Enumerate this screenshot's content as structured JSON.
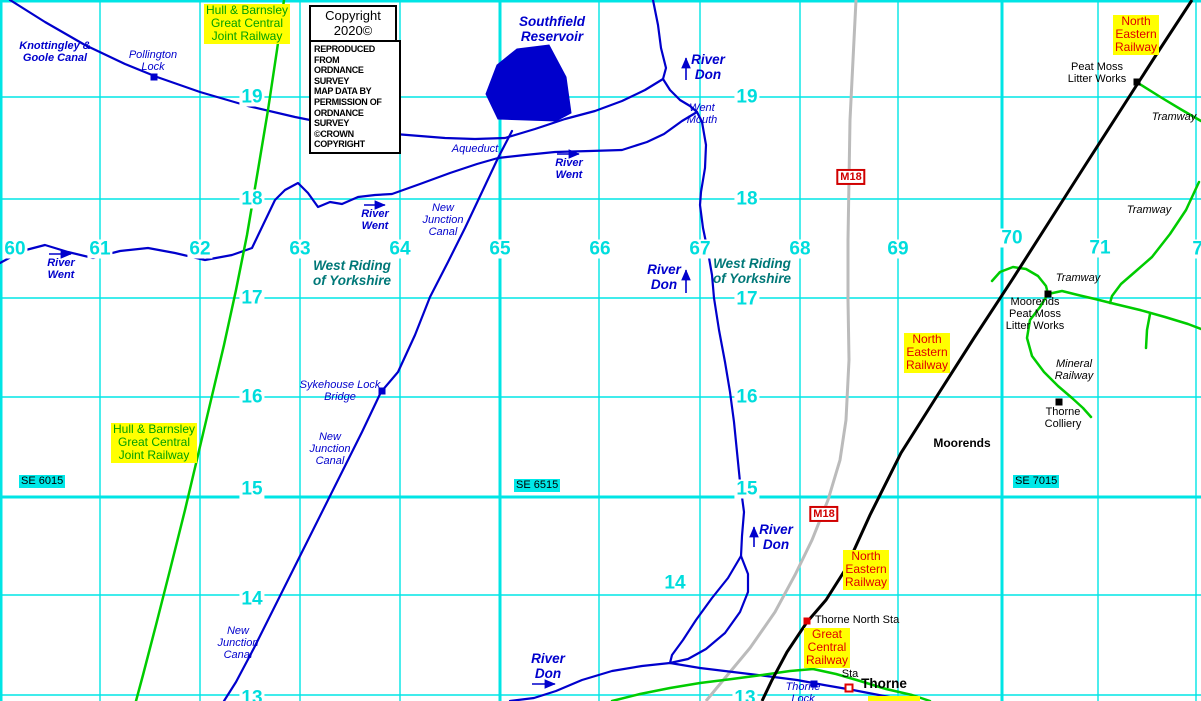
{
  "map": {
    "title": "Keymaps GB railway map — Thorne / Moorends area",
    "colors": {
      "grid_cyan": "#00E5E5",
      "waterway_blue": "#0000CC",
      "railway_green": "#00CC00",
      "railway_black": "#000000",
      "road_grey": "#BBBBBB",
      "highlight_yellow": "#FFFF00",
      "label_red": "#E00000",
      "label_teal": "#007878"
    },
    "attribution": {
      "line1": "Copyright 2020©",
      "line2": "KeymapsGB"
    },
    "os_notice": [
      "REPRODUCED FROM",
      "ORDNANCE SURVEY",
      "MAP DATA BY",
      "PERMISSION OF",
      "ORDNANCE SURVEY",
      "©CROWN COPYRIGHT"
    ],
    "labels": [
      {
        "id": "knottingley-goole-canal",
        "style": "wib",
        "x": 55,
        "y": 41,
        "lines": [
          "Knottingley &",
          "Goole Canal"
        ]
      },
      {
        "id": "pollington-lock",
        "style": "wi",
        "x": 153,
        "y": 50,
        "lines": [
          "Pollington",
          "Lock"
        ]
      },
      {
        "id": "hull-barnsley-railway-1",
        "style": "yg",
        "x": 247,
        "y": 4,
        "lines": [
          "Hull & Barnsley",
          "Great Central",
          "Joint Railway"
        ]
      },
      {
        "id": "southfield-reservoir",
        "style": "wb",
        "x": 552,
        "y": 15,
        "lines": [
          "Southfield",
          "Reservoir"
        ]
      },
      {
        "id": "river-don-1",
        "style": "wb",
        "x": 708,
        "y": 53,
        "lines": [
          "River",
          "Don"
        ]
      },
      {
        "id": "went-mouth",
        "style": "wi",
        "x": 702,
        "y": 103,
        "lines": [
          "Went",
          "Mouth"
        ]
      },
      {
        "id": "aqueduct",
        "style": "wi",
        "x": 475,
        "y": 144,
        "lines": [
          "Aqueduct"
        ]
      },
      {
        "id": "river-went-1",
        "style": "wib",
        "x": 61,
        "y": 258,
        "lines": [
          "River",
          "Went"
        ]
      },
      {
        "id": "river-went-2",
        "style": "wib",
        "x": 375,
        "y": 209,
        "lines": [
          "River",
          "Went"
        ]
      },
      {
        "id": "river-went-3",
        "style": "wib",
        "x": 569,
        "y": 158,
        "lines": [
          "River",
          "Went"
        ]
      },
      {
        "id": "new-junction-canal-1",
        "style": "wi",
        "x": 443,
        "y": 203,
        "lines": [
          "New",
          "Junction",
          "Canal"
        ]
      },
      {
        "id": "west-riding-of-yorkshire-1",
        "style": "teal",
        "x": 352,
        "y": 259,
        "lines": [
          "West Riding",
          "of Yorkshire"
        ]
      },
      {
        "id": "west-riding-of-yorkshire-2",
        "style": "teal",
        "x": 752,
        "y": 257,
        "lines": [
          "West Riding",
          "of Yorkshire"
        ]
      },
      {
        "id": "north-eastern-railway-1",
        "style": "yr",
        "x": 1136,
        "y": 15,
        "lines": [
          "North",
          "Eastern",
          "Railway"
        ]
      },
      {
        "id": "peat-moss-litter-works",
        "style": "blk",
        "x": 1097,
        "y": 62,
        "lines": [
          "Peat Moss",
          "Litter Works"
        ]
      },
      {
        "id": "tramway-1",
        "style": "bi",
        "x": 1174,
        "y": 112,
        "lines": [
          "Tramway"
        ]
      },
      {
        "id": "tramway-2",
        "style": "bi",
        "x": 1149,
        "y": 205,
        "lines": [
          "Tramway"
        ]
      },
      {
        "id": "tramway-3",
        "style": "bi",
        "x": 1078,
        "y": 273,
        "lines": [
          "Tramway"
        ]
      },
      {
        "id": "river-don-2",
        "style": "wb",
        "x": 664,
        "y": 263,
        "lines": [
          "River",
          "Don"
        ]
      },
      {
        "id": "moorends-peat-moss-litter-works",
        "style": "blk",
        "x": 1035,
        "y": 297,
        "lines": [
          "Moorends",
          "Peat Moss",
          "Litter Works"
        ]
      },
      {
        "id": "north-eastern-railway-2",
        "style": "yr",
        "x": 927,
        "y": 333,
        "lines": [
          "North",
          "Eastern",
          "Railway"
        ]
      },
      {
        "id": "mineral-railway",
        "style": "bi",
        "x": 1074,
        "y": 359,
        "lines": [
          "Mineral",
          "Railway"
        ]
      },
      {
        "id": "sykehouse-lock-bridge",
        "style": "wi",
        "x": 340,
        "y": 380,
        "lines": [
          "Sykehouse Lock",
          "Bridge"
        ]
      },
      {
        "id": "thorne-colliery",
        "style": "blk",
        "x": 1063,
        "y": 407,
        "lines": [
          "Thorne",
          "Colliery"
        ]
      },
      {
        "id": "hull-barnsley-railway-2",
        "style": "yg",
        "x": 154,
        "y": 423,
        "lines": [
          "Hull & Barnsley",
          "Great Central",
          "Joint Railway"
        ]
      },
      {
        "id": "new-junction-canal-2",
        "style": "wi",
        "x": 330,
        "y": 432,
        "lines": [
          "New",
          "Junction",
          "Canal"
        ]
      },
      {
        "id": "moorends",
        "style": "bb",
        "x": 962,
        "y": 437,
        "lines": [
          "Moorends"
        ]
      },
      {
        "id": "river-don-3",
        "style": "wb",
        "x": 776,
        "y": 523,
        "lines": [
          "River",
          "Don"
        ]
      },
      {
        "id": "north-eastern-railway-3",
        "style": "yr",
        "x": 866,
        "y": 550,
        "lines": [
          "North",
          "Eastern",
          "Railway"
        ]
      },
      {
        "id": "thorne-north-sta",
        "style": "blk",
        "x": 857,
        "y": 615,
        "lines": [
          "Thorne North Sta"
        ]
      },
      {
        "id": "great-central-railway",
        "style": "yr",
        "x": 827,
        "y": 628,
        "lines": [
          "Great",
          "Central",
          "Railway"
        ]
      },
      {
        "id": "new-junction-canal-3",
        "style": "wi",
        "x": 238,
        "y": 626,
        "lines": [
          "New",
          "Junction",
          "Canal"
        ]
      },
      {
        "id": "river-don-4",
        "style": "wb",
        "x": 548,
        "y": 652,
        "lines": [
          "River",
          "Don"
        ]
      },
      {
        "id": "sta",
        "style": "blk",
        "x": 850,
        "y": 669,
        "lines": [
          "Sta"
        ]
      },
      {
        "id": "thorne",
        "style": "bb2",
        "x": 884,
        "y": 677,
        "lines": [
          "Thorne"
        ]
      },
      {
        "id": "thorne-lock",
        "style": "wi",
        "x": 803,
        "y": 682,
        "lines": [
          "Thorne",
          "Lock"
        ]
      }
    ],
    "grid": {
      "column_numbers": [
        {
          "text": "60",
          "x": 15,
          "y": 249
        },
        {
          "text": "61",
          "x": 100,
          "y": 249
        },
        {
          "text": "62",
          "x": 200,
          "y": 249
        },
        {
          "text": "63",
          "x": 300,
          "y": 249
        },
        {
          "text": "64",
          "x": 400,
          "y": 249
        },
        {
          "text": "65",
          "x": 500,
          "y": 249
        },
        {
          "text": "66",
          "x": 600,
          "y": 249
        },
        {
          "text": "67",
          "x": 700,
          "y": 249
        },
        {
          "text": "68",
          "x": 800,
          "y": 249
        },
        {
          "text": "69",
          "x": 898,
          "y": 249
        },
        {
          "text": "70",
          "x": 1012,
          "y": 238
        },
        {
          "text": "71",
          "x": 1100,
          "y": 248
        },
        {
          "text": "72",
          "x": 1203,
          "y": 249
        }
      ],
      "row_numbers": [
        {
          "text": "19",
          "x": 252,
          "y": 97
        },
        {
          "text": "19",
          "x": 747,
          "y": 97
        },
        {
          "text": "18",
          "x": 252,
          "y": 199
        },
        {
          "text": "18",
          "x": 747,
          "y": 199
        },
        {
          "text": "17",
          "x": 252,
          "y": 298
        },
        {
          "text": "17",
          "x": 747,
          "y": 299
        },
        {
          "text": "16",
          "x": 252,
          "y": 397
        },
        {
          "text": "16",
          "x": 747,
          "y": 397
        },
        {
          "text": "15",
          "x": 252,
          "y": 489
        },
        {
          "text": "15",
          "x": 747,
          "y": 489
        },
        {
          "text": "14",
          "x": 252,
          "y": 599
        },
        {
          "text": "14",
          "x": 675,
          "y": 583
        },
        {
          "text": "13",
          "x": 252,
          "y": 698
        },
        {
          "text": "13",
          "x": 745,
          "y": 698
        }
      ],
      "square_refs": [
        {
          "text": "SE 6015",
          "x": 19,
          "y": 475
        },
        {
          "text": "SE 6515",
          "x": 514,
          "y": 479
        },
        {
          "text": "SE 7015",
          "x": 1013,
          "y": 475
        }
      ]
    },
    "road_badges": [
      {
        "text": "M18",
        "x": 851,
        "y": 177
      },
      {
        "text": "M18",
        "x": 824,
        "y": 514
      }
    ],
    "markers": [
      {
        "id": "pollington-lock-marker",
        "type": "blue",
        "x": 154,
        "y": 77
      },
      {
        "id": "sykehouse-lock-bridge-marker",
        "type": "blue",
        "x": 382,
        "y": 391
      },
      {
        "id": "thorne-lock-marker",
        "type": "blue",
        "x": 814,
        "y": 684
      },
      {
        "id": "peat-moss-litter-works-marker",
        "type": "black",
        "x": 1137,
        "y": 82
      },
      {
        "id": "moorends-peat-moss-litter-works-marker",
        "type": "black",
        "x": 1048,
        "y": 294
      },
      {
        "id": "thorne-colliery-marker",
        "type": "black",
        "x": 1059,
        "y": 402
      },
      {
        "id": "thorne-north-sta-marker",
        "type": "red",
        "x": 807,
        "y": 621
      },
      {
        "id": "thorne-sta-marker",
        "type": "red-open",
        "x": 849,
        "y": 688
      }
    ]
  }
}
